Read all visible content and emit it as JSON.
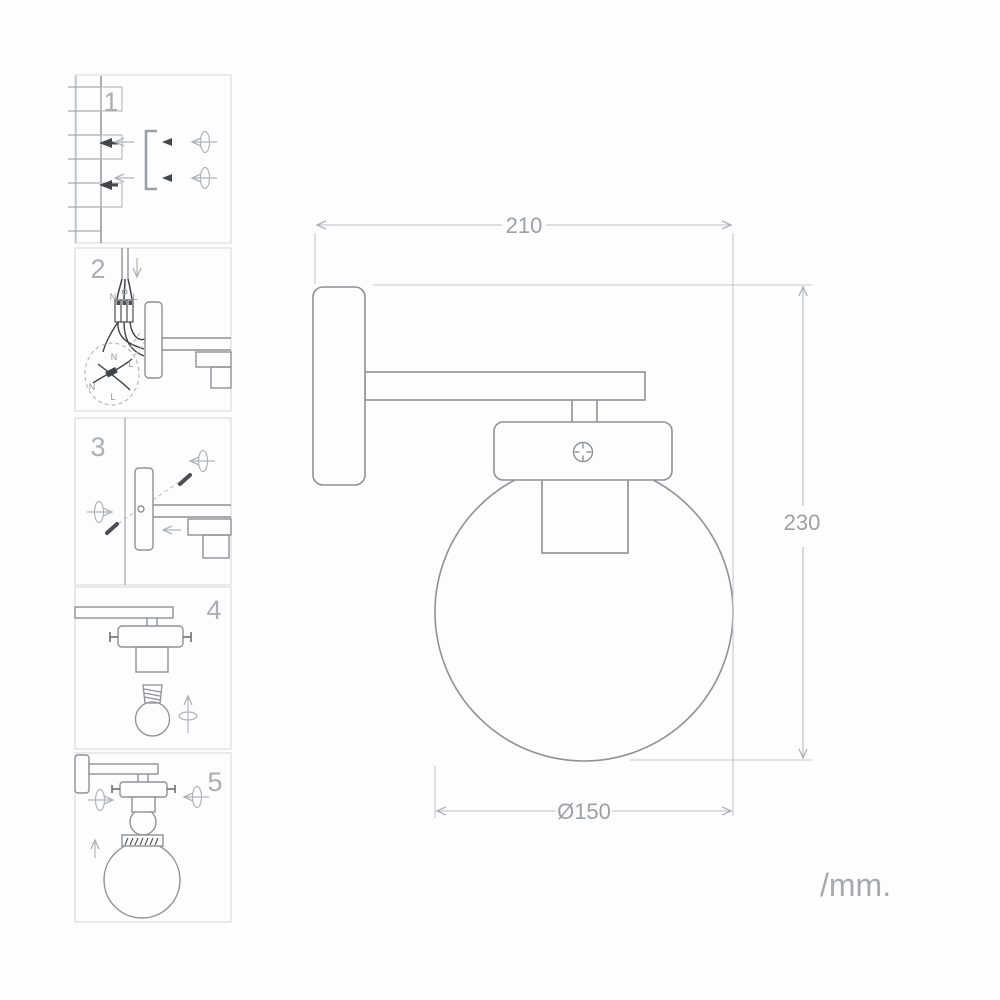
{
  "units_label": "/mm.",
  "dimensions": {
    "width_mm": "210",
    "height_mm": "230",
    "globe_diameter_mm": "Ø150"
  },
  "steps": [
    {
      "number": "1"
    },
    {
      "number": "2",
      "wire_labels": {
        "top_neutral": "N",
        "top_live": "L",
        "detail": [
          "N",
          "L",
          "N",
          "L"
        ]
      }
    },
    {
      "number": "3"
    },
    {
      "number": "4"
    },
    {
      "number": "5"
    }
  ],
  "colors": {
    "background": "#fdfdfe",
    "object_line": "#8d9297",
    "panel_line": "#969ba0",
    "dimension_line": "#b7bcc0",
    "text_gray": "#9ba1a6",
    "dark_detail": "#43484c",
    "panel_border": "#d4d7da"
  }
}
